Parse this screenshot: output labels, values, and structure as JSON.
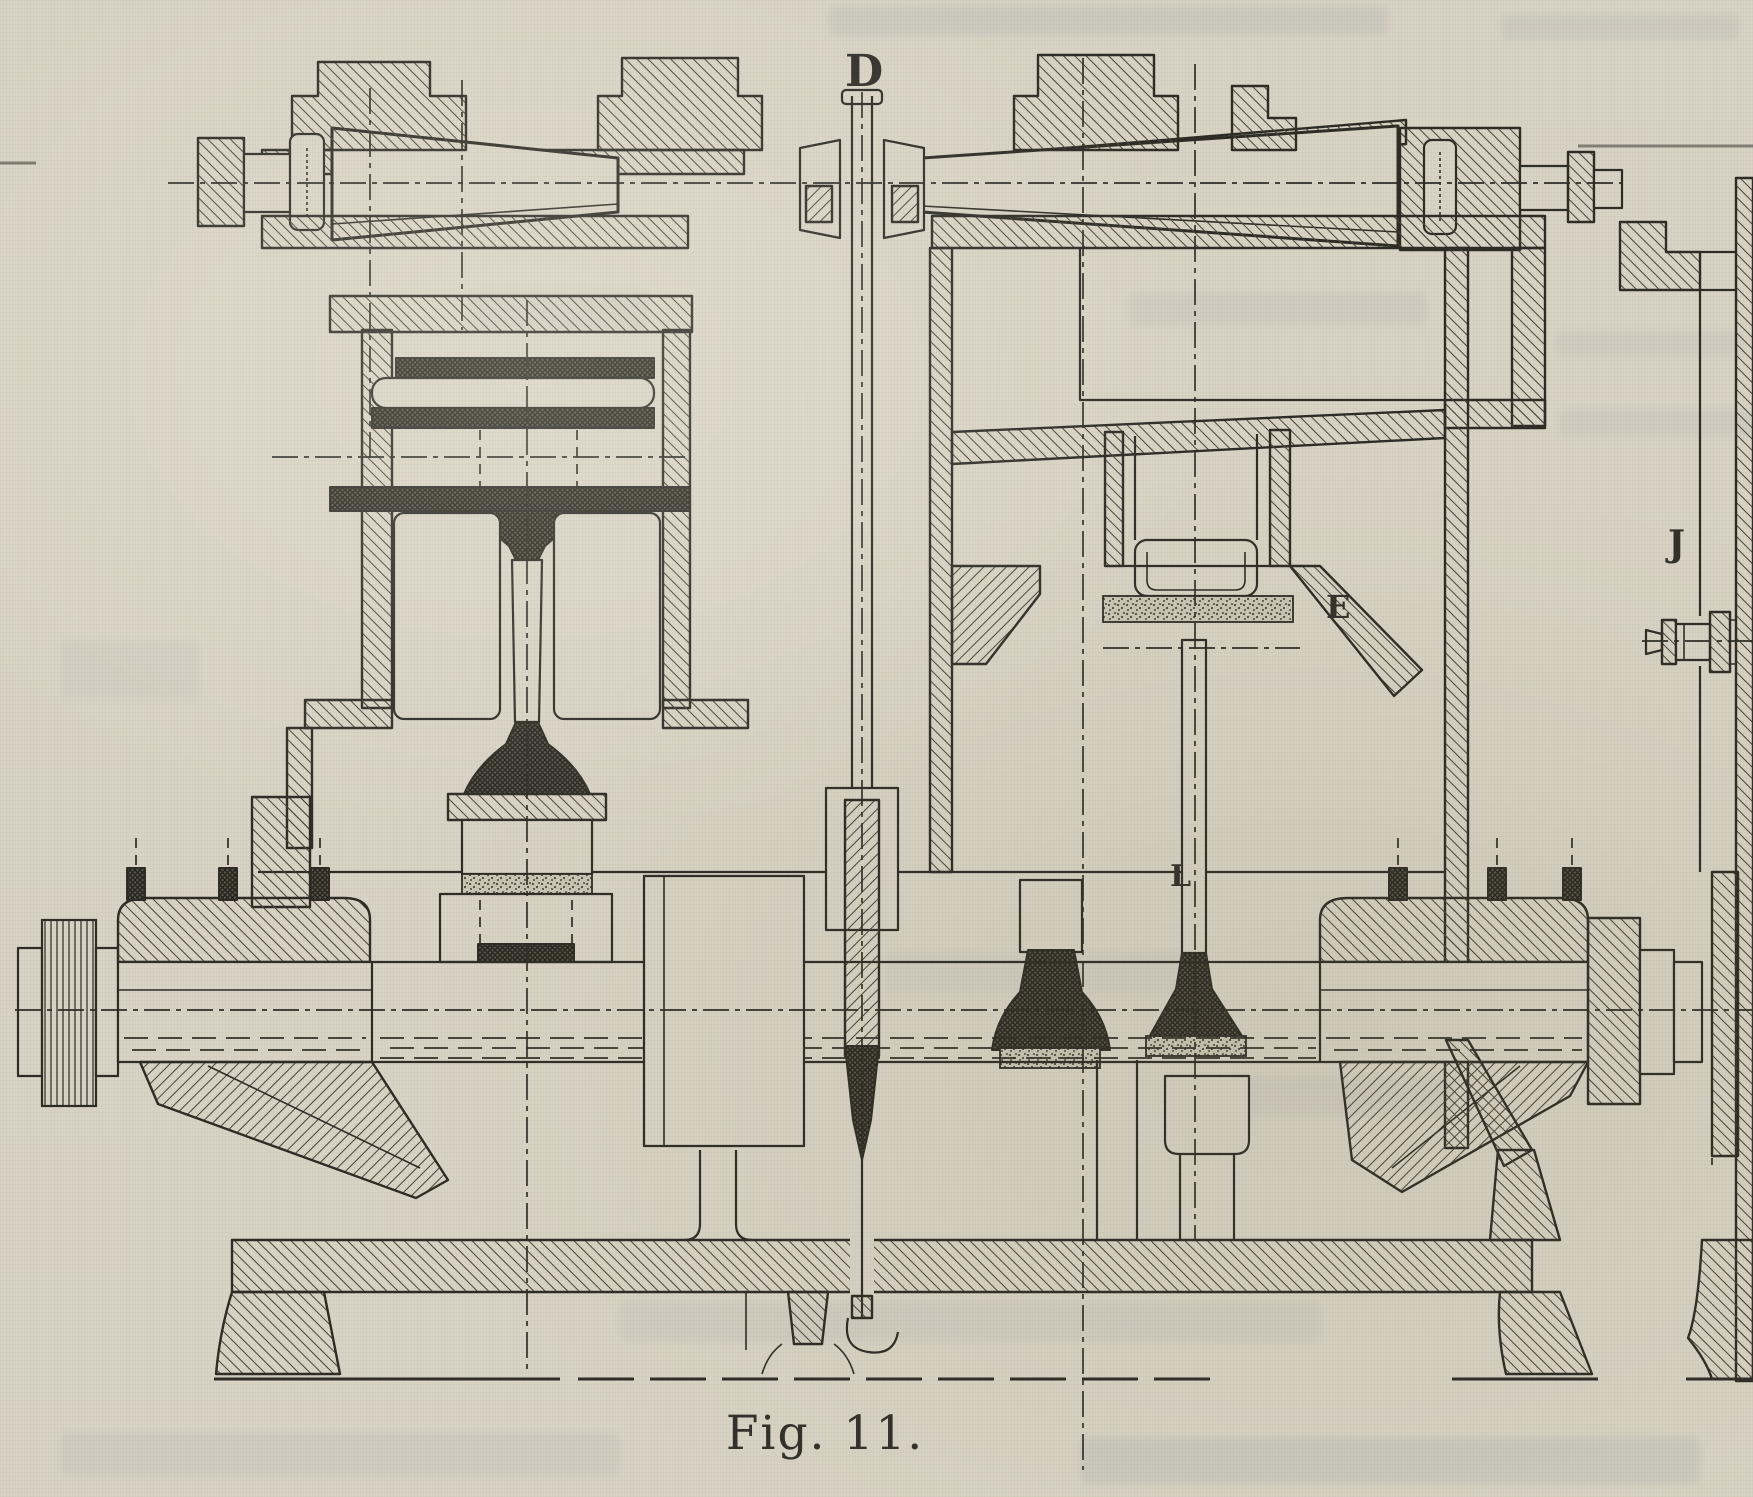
{
  "page": {
    "kind": "scanned-book-figure",
    "paper_color": "#d8d3c4",
    "ink_color": "#2e2c25",
    "hatch_color": "#474336",
    "dark_fill_color": "#595447",
    "ghost_print_color": "#6f7a8e",
    "label_color": "#33302a"
  },
  "figure": {
    "caption": "Fig. 11.",
    "labels": {
      "d": "D",
      "e": "E",
      "j": "J",
      "l": "L"
    }
  }
}
